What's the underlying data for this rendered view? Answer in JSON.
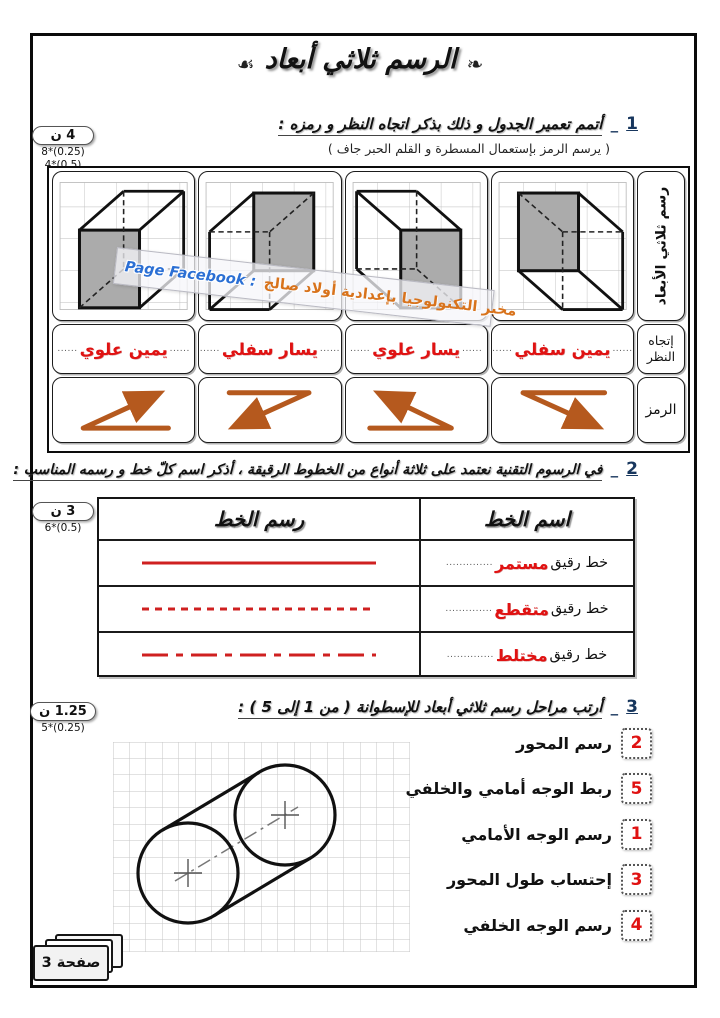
{
  "ui": {
    "leader_dots_long": "..............",
    "leader_dots_short": "......"
  },
  "page": {
    "footer_label": "صفحة 3"
  },
  "title": {
    "ornament_right": "☙",
    "text": "الرسم ثلاثي أبعاد",
    "ornament_left": "❧"
  },
  "watermark": {
    "page_facebook": "Page Facebook :",
    "lab_name": "مخبر التكنولوجيا بإعدادية أولاد صالح"
  },
  "q1": {
    "number": "1",
    "separator": "_",
    "heading": "أتمم تعمير الجدول و ذلك بذكر اتجاه النظر و رمزه :",
    "subheading": "( يرسم الرمز بإستعمال المسطرة و القلم الحبر جاف )",
    "score": {
      "points": "4 ن",
      "detail_1": "8*(0.25)",
      "detail_2": "4*(0.5)"
    },
    "table": {
      "header_drawing": "رسم ثلاثي الأبعاد",
      "header_direction_line1": "إتجاه",
      "header_direction_line2": "النظر",
      "header_symbol": "الرمز",
      "columns": [
        {
          "direction": "يمين علوي",
          "arrow": "up-right"
        },
        {
          "direction": "يسار سفلي",
          "arrow": "down-left"
        },
        {
          "direction": "يسار علوي",
          "arrow": "up-left"
        },
        {
          "direction": "يمين سفلي",
          "arrow": "down-right"
        }
      ]
    }
  },
  "q2": {
    "number": "2",
    "separator": "_",
    "heading": "في الرسوم التقنية نعتمد على ثلاثة أنواع من الخطوط الرقيقة ، أذكر اسم كلّ خط و رسمه المناسب :",
    "score": {
      "points": "3 ن",
      "detail_1": "6*(0.5)"
    },
    "table": {
      "header_name": "اسم الخط",
      "header_drawing": "رسم الخط",
      "rows": [
        {
          "prefix": "خط رقيق",
          "answer": "مستمر",
          "line_style": "solid"
        },
        {
          "prefix": "خط رقيق",
          "answer": "متقطع",
          "line_style": "dashed"
        },
        {
          "prefix": "خط رقيق",
          "answer": "مختلط",
          "line_style": "dash-dot"
        }
      ]
    }
  },
  "q3": {
    "number": "3",
    "separator": "_",
    "heading": "أرتب مراحل رسم ثلاثي أبعاد للإسطوانة ( من 1 إلى 5 ) :",
    "score": {
      "points": "1.25 ن",
      "detail_1": "5*(0.25)"
    },
    "steps": [
      {
        "order": "2",
        "label": "رسم المحور"
      },
      {
        "order": "5",
        "label": "ربط الوجه أمامي والخلفي"
      },
      {
        "order": "1",
        "label": "رسم الوجه الأمامي"
      },
      {
        "order": "3",
        "label": "إحتساب طول المحور"
      },
      {
        "order": "4",
        "label": "رسم الوجه الخلفي"
      }
    ]
  },
  "colors": {
    "answer_red": "#e01212",
    "arrow_orange": "#b5591e",
    "sample_line_red": "#cf2020",
    "question_number_blue": "#17365d",
    "facebook_blue": "#2b6fd4",
    "lab_orange": "#d8731c"
  }
}
